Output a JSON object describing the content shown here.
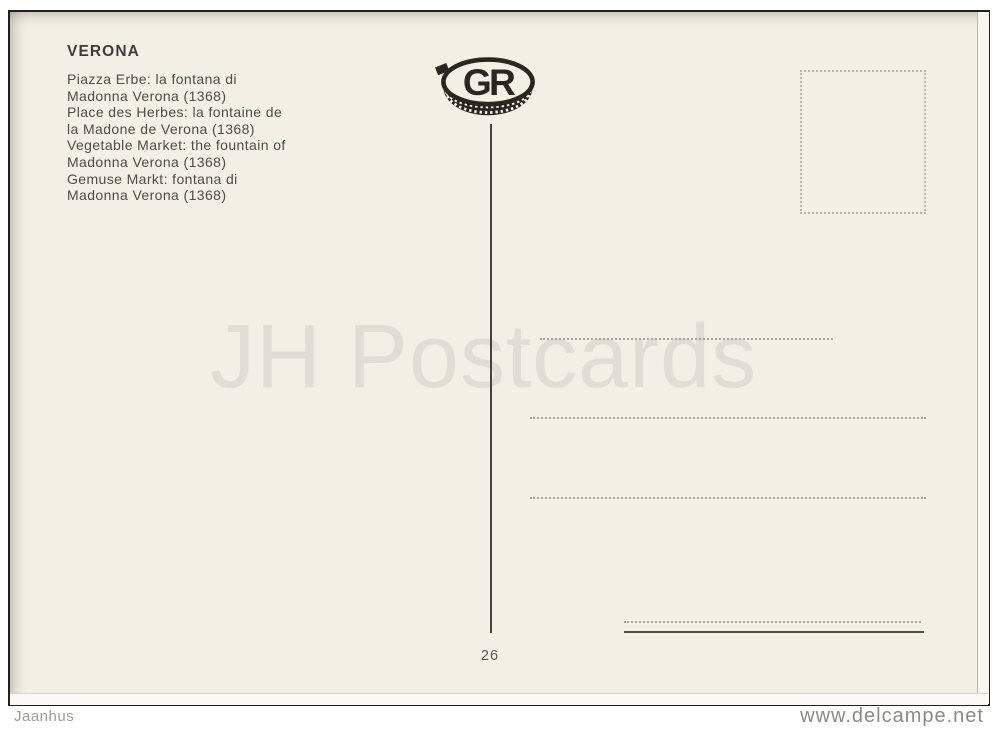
{
  "colors": {
    "page_background": "#ffffff",
    "card_background": "#f2efe4",
    "ink": "#4e4c46",
    "frame_border": "#21201c",
    "watermark_gray": "#dfddd4",
    "dotted_line_gray": "#a7a49a"
  },
  "card": {
    "title": "VERONA",
    "caption_lines": [
      "Piazza Erbe: la fontana di",
      "Madonna Verona (1368)",
      "Place des Herbes: la fontaine de",
      "la Madone de Verona (1368)",
      "Vegetable Market: the fountain of",
      "Madonna Verona (1368)",
      "Gemuse Markt: fontana di",
      "Madonna Verona (1368)"
    ],
    "publisher_logo_letters": "GR",
    "watermark": "JH Postcards",
    "card_number": "26"
  },
  "footer": {
    "seller": "Jaanhus",
    "site": "www.delcampe.net"
  }
}
